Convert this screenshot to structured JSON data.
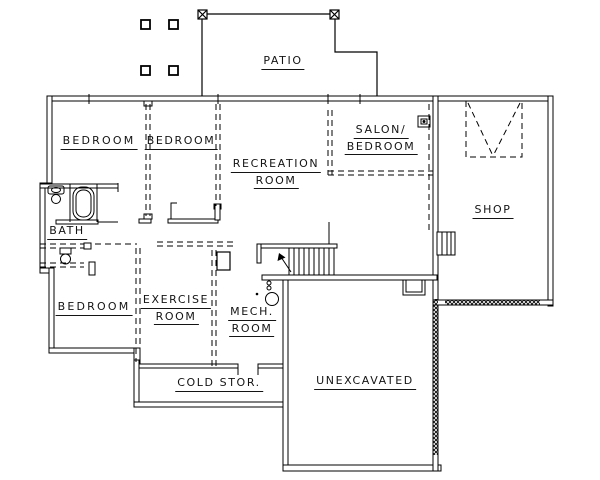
{
  "plan": {
    "background": "#ffffff",
    "line_color": "#000000",
    "text_color": "#141414",
    "rooms": {
      "patio": {
        "label": "PATIO"
      },
      "bedroom_top_left": {
        "label": "BEDROOM"
      },
      "bedroom_top_middle": {
        "label": "BEDROOM"
      },
      "recreation_room": {
        "line1": "RECREATION",
        "line2": "ROOM"
      },
      "salon_bedroom": {
        "line1": "SALON/",
        "line2": "BEDROOM"
      },
      "shop": {
        "label": "SHOP"
      },
      "bath": {
        "label": "BATH"
      },
      "bedroom_bottom_left": {
        "label": "BEDROOM"
      },
      "exercise_room": {
        "line1": "EXERCISE",
        "line2": "ROOM"
      },
      "mech_room": {
        "line1": "MECH.",
        "line2": "ROOM"
      },
      "cold_storage": {
        "label": "COLD STOR."
      },
      "unexcavated": {
        "label": "UNEXCAVATED"
      }
    },
    "icons": [
      "patio-post-icon",
      "patio-column-icon",
      "bathtub-icon",
      "sink-icon",
      "toilet-icon",
      "stairs-icon",
      "stair-direction-arrow-icon",
      "furnace-icon",
      "water-heater-icon",
      "chimney-icon",
      "window-well-icon",
      "ceiling-fixture-icon",
      "foundation-hatch"
    ]
  }
}
